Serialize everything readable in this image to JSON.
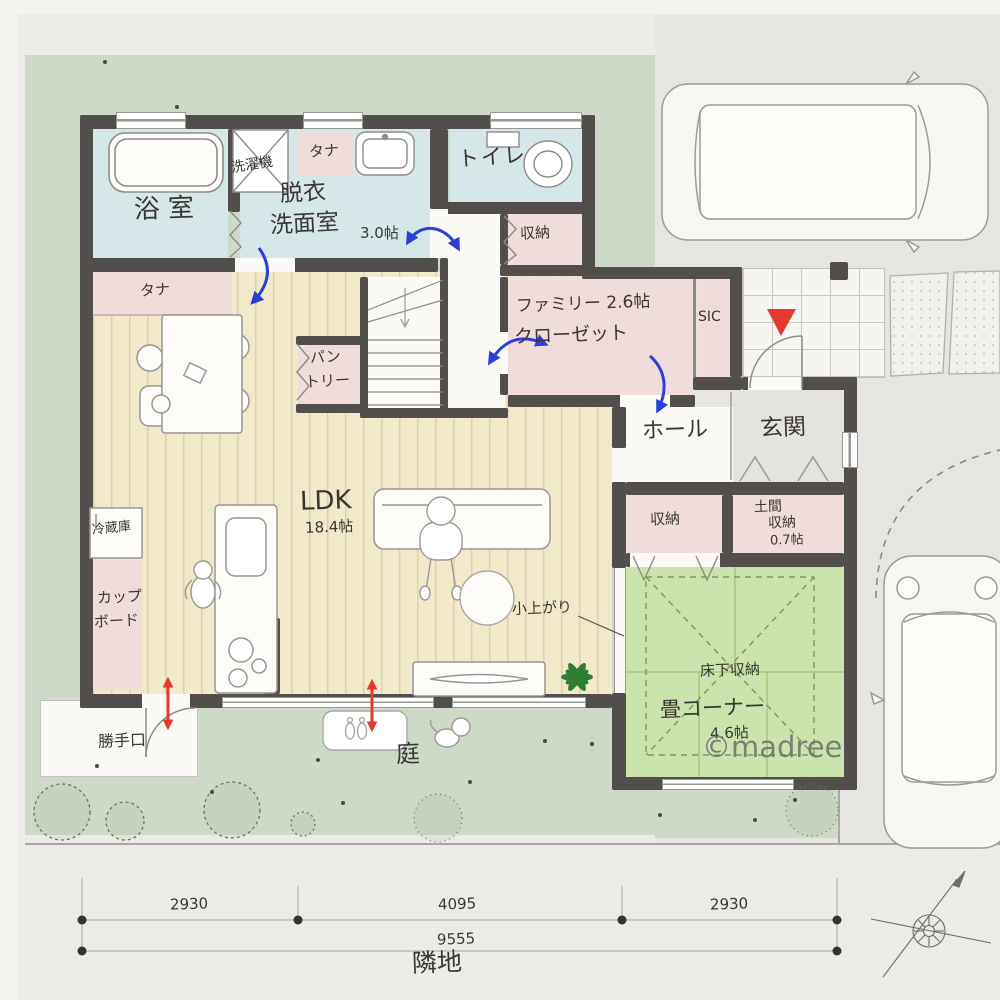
{
  "plan": {
    "rooms": {
      "bath": "浴室",
      "laundry": "洗濯機",
      "shelf_a": "タナ",
      "shelf_b": "タナ",
      "washroom_l1": "脱衣",
      "washroom_l2": "洗面室",
      "washroom_size": "3.0帖",
      "toilet": "トイレ",
      "storage_upper": "収納",
      "family_closet_l1": "ファミリー 2.6帖",
      "family_closet_l2": "クローゼット",
      "sic": "SIC",
      "pantry_l1": "パン",
      "pantry_l2": "トリー",
      "hall": "ホール",
      "entrance": "玄関",
      "storage_hall": "収納",
      "doma_l1": "土間",
      "doma_l2": "収納",
      "doma_size": "0.7帖",
      "ldk": "LDK",
      "ldk_size": "18.4帖",
      "fridge": "冷蔵庫",
      "cupboard_l1": "カップ",
      "cupboard_l2": "ボード",
      "koagari": "小上がり",
      "floor_storage": "床下収納",
      "tatami": "畳コーナー",
      "tatami_size": "4.6帖",
      "back_door": "勝手口",
      "garden": "庭"
    },
    "dimensions": {
      "segments": [
        "2930",
        "4095",
        "2930"
      ],
      "total": "9555"
    },
    "site": {
      "neighbor": "隣地",
      "watermark": "©madree"
    },
    "colors": {
      "wall": "#514e4b",
      "lawn_green": "#cedac8",
      "wood_floor": "#f2e9cb",
      "wet_area_blue": "#d6e7e9",
      "storage_pink": "#f0dcd8",
      "tatami_green": "#cbe4ad",
      "arrow_blue": "#2b3fd8",
      "accent_red": "#e23b2e"
    }
  }
}
